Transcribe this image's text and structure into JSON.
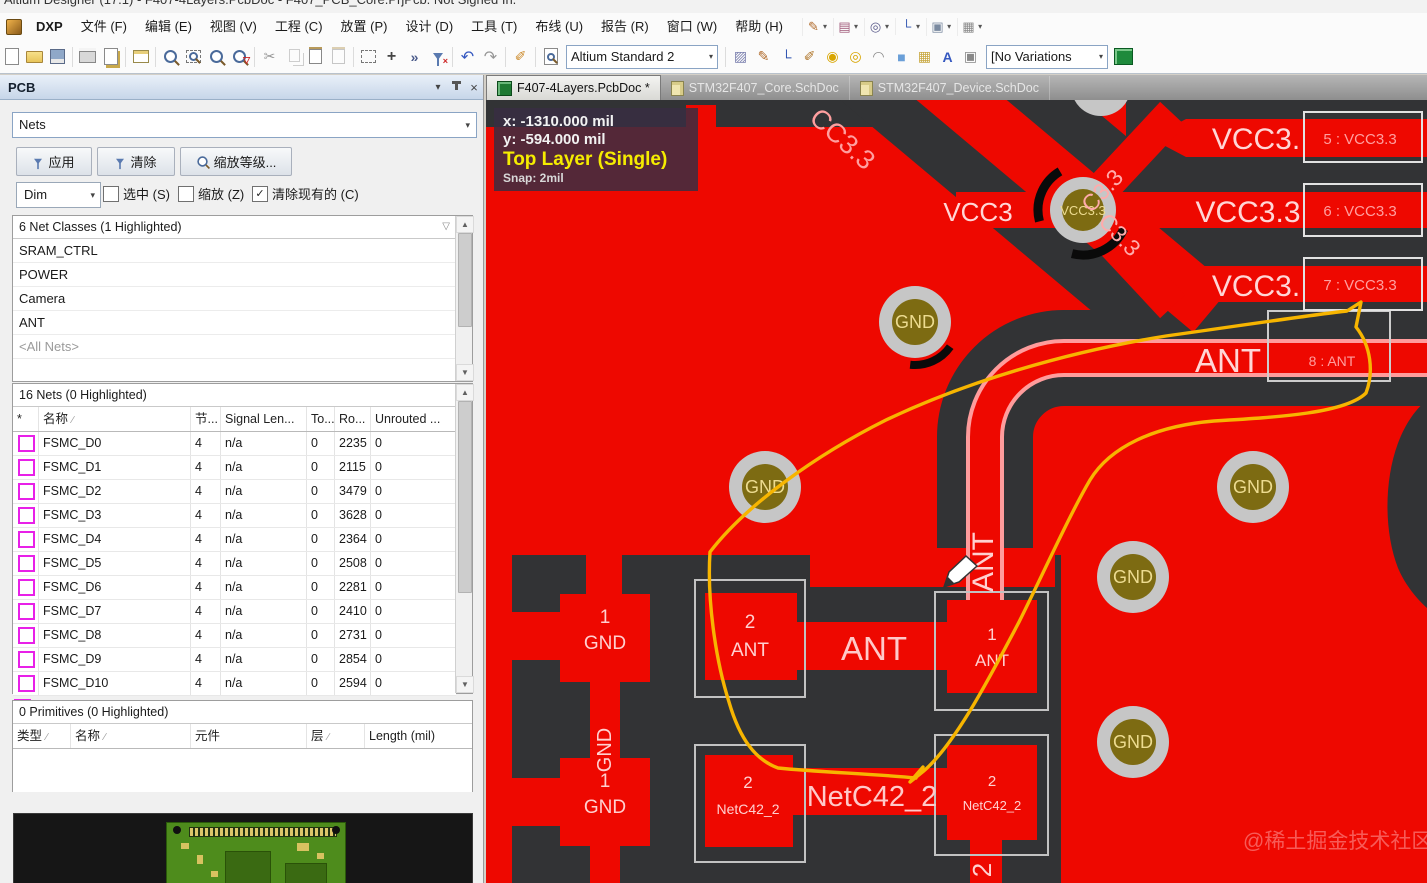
{
  "window": {
    "title_fragment": "Altium Designer (17.1) - F407-4Layers.PcbDoc - F407_PCB_Core.PrjPcb. Not Signed In."
  },
  "menu": {
    "dxp": "DXP",
    "items": [
      "文件 (F)",
      "编辑 (E)",
      "视图 (V)",
      "工程 (C)",
      "放置 (P)",
      "设计 (D)",
      "工具 (T)",
      "布线 (U)",
      "报告 (R)",
      "窗口 (W)",
      "帮助 (H)"
    ]
  },
  "toolbar": {
    "combo1": "Altium Standard 2",
    "combo2": "[No Variations"
  },
  "tabs": [
    {
      "label": "F407-4Layers.PcbDoc *"
    },
    {
      "label": "STM32F407_Core.SchDoc"
    },
    {
      "label": "STM32F407_Device.SchDoc"
    }
  ],
  "pcb_panel": {
    "title": "PCB",
    "mode_select": "Nets",
    "apply_button": "应用",
    "clear_button": "清除",
    "zoom_button": "缩放等级...",
    "dim_select": "Dim",
    "checkboxes": [
      {
        "label": "选中 (S)",
        "checked": false
      },
      {
        "label": "缩放 (Z)",
        "checked": false
      },
      {
        "label": "清除现有的 (C)",
        "checked": true
      }
    ],
    "net_classes": {
      "header": "6 Net Classes (1 Highlighted)",
      "items": [
        "SRAM_CTRL",
        "POWER",
        "Camera",
        "ANT",
        "<All Nets>"
      ]
    },
    "nets": {
      "header": "16 Nets (0 Highlighted)",
      "columns": [
        "*",
        "名称",
        "节...",
        "Signal Len...",
        "To...",
        "Ro...",
        "Unrouted ..."
      ],
      "rows": [
        {
          "name": "FSMC_D0",
          "nodes": "4",
          "signal_len": "n/a",
          "to": "0",
          "ro": "2235",
          "unrouted": "0"
        },
        {
          "name": "FSMC_D1",
          "nodes": "4",
          "signal_len": "n/a",
          "to": "0",
          "ro": "2115",
          "unrouted": "0"
        },
        {
          "name": "FSMC_D2",
          "nodes": "4",
          "signal_len": "n/a",
          "to": "0",
          "ro": "3479",
          "unrouted": "0"
        },
        {
          "name": "FSMC_D3",
          "nodes": "4",
          "signal_len": "n/a",
          "to": "0",
          "ro": "3628",
          "unrouted": "0"
        },
        {
          "name": "FSMC_D4",
          "nodes": "4",
          "signal_len": "n/a",
          "to": "0",
          "ro": "2364",
          "unrouted": "0"
        },
        {
          "name": "FSMC_D5",
          "nodes": "4",
          "signal_len": "n/a",
          "to": "0",
          "ro": "2508",
          "unrouted": "0"
        },
        {
          "name": "FSMC_D6",
          "nodes": "4",
          "signal_len": "n/a",
          "to": "0",
          "ro": "2281",
          "unrouted": "0"
        },
        {
          "name": "FSMC_D7",
          "nodes": "4",
          "signal_len": "n/a",
          "to": "0",
          "ro": "2410",
          "unrouted": "0"
        },
        {
          "name": "FSMC_D8",
          "nodes": "4",
          "signal_len": "n/a",
          "to": "0",
          "ro": "2731",
          "unrouted": "0"
        },
        {
          "name": "FSMC_D9",
          "nodes": "4",
          "signal_len": "n/a",
          "to": "0",
          "ro": "2854",
          "unrouted": "0"
        },
        {
          "name": "FSMC_D10",
          "nodes": "4",
          "signal_len": "n/a",
          "to": "0",
          "ro": "2594",
          "unrouted": "0"
        }
      ]
    },
    "primitives": {
      "header": "0 Primitives (0 Highlighted)",
      "columns": [
        "类型",
        "名称",
        "元件",
        "层",
        "Length (mil)"
      ]
    }
  },
  "hud": {
    "x": "x: -1310.000 mil",
    "y": "y:  -594.000 mil",
    "layer": "Top Layer (Single)",
    "snap": "Snap: 2mil"
  },
  "canvas": {
    "bands": [
      {
        "label": "VCC3.",
        "pin": "5 : VCC3.3"
      },
      {
        "label": "VCC3.3",
        "pin": "6 : VCC3.3"
      },
      {
        "label": "VCC3.",
        "pin": "7 : VCC3.3"
      }
    ],
    "vcc_clip": "VCC3",
    "diag_top": "CC3.3",
    "diag_a": "C3.3",
    "diag_b": "C3.3",
    "via_vcc": "VCC3.3",
    "via_gnd": "GND",
    "ant_band": {
      "label": "ANT",
      "pin": "8 : ANT"
    },
    "pads": {
      "gnd1": {
        "num": "1",
        "net": "GND"
      },
      "gnd2": {
        "num": "1",
        "net": "GND"
      },
      "ant2": {
        "num": "2",
        "net": "ANT"
      },
      "ant1": {
        "num": "1",
        "net": "ANT"
      },
      "net_l": {
        "num": "2",
        "net": "NetC42_2"
      },
      "net_r": {
        "num": "2",
        "net": "NetC42_2"
      }
    },
    "traces": {
      "ant": "ANT",
      "net": "NetC42_2",
      "gnd_vertical": "GND",
      "ant_vertical": "ANT",
      "two_vertical": "2"
    },
    "watermark": "@稀土掘金技术社区"
  },
  "icons": {
    "chevron_down": "▾",
    "close": "×",
    "check": "✓",
    "sort_asc": "∕",
    "filter_small": "▽",
    "arrow_up": "▲",
    "arrow_down": "▼",
    "scissors": "✂",
    "undo": "↶",
    "redo": "↷",
    "pen": "✎",
    "pen_alt": "✐",
    "hatch": "▨",
    "route_corner": "└",
    "pad": "◉",
    "via": "◎",
    "arc": "◠",
    "fill_square": "■",
    "pattern": "▦",
    "text_a": "A",
    "chip": "▣",
    "layers": "▤",
    "move_cross": "+",
    "snap": "»"
  }
}
